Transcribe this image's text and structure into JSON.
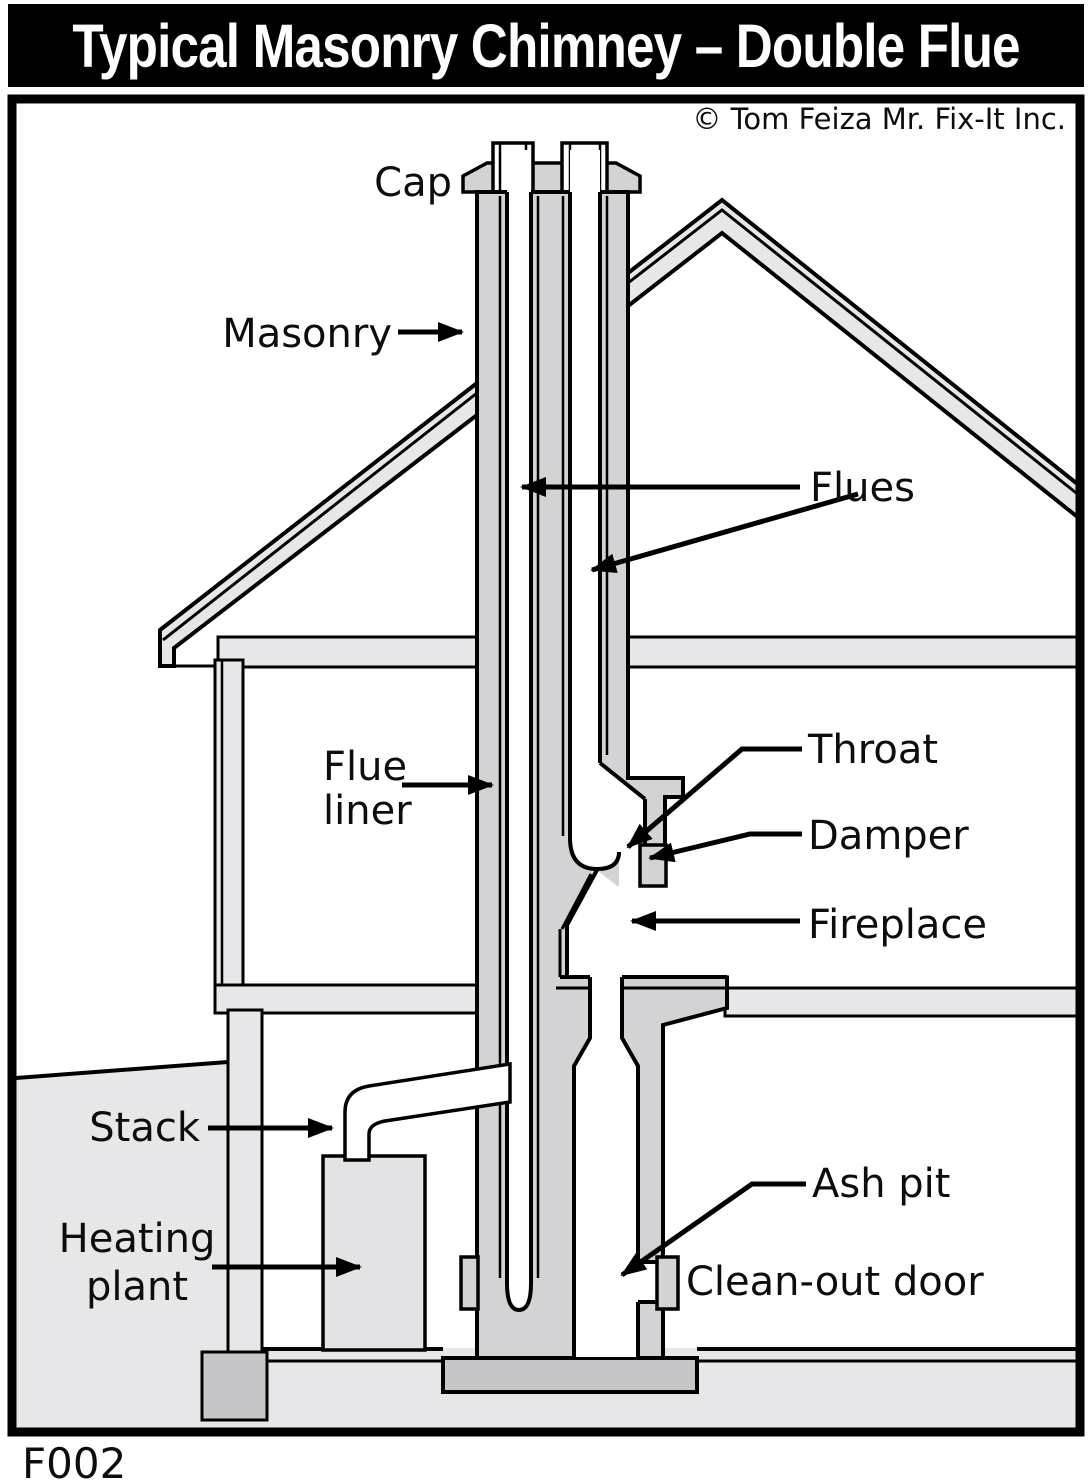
{
  "title": "Typical Masonry Chimney – Double Flue",
  "copyright": "© Tom Feiza Mr. Fix-It Inc.",
  "figure_code": "F002",
  "labels": {
    "cap": "Cap",
    "masonry": "Masonry",
    "flues": "Flues",
    "flue_liner_line1": "Flue",
    "flue_liner_line2": "liner",
    "throat": "Throat",
    "damper": "Damper",
    "fireplace": "Fireplace",
    "stack": "Stack",
    "heating_line1": "Heating",
    "heating_line2": "plant",
    "ash_pit": "Ash pit",
    "cleanout_door": "Clean-out door"
  },
  "colors": {
    "line": "#000000",
    "masonry": "#d3d3d5",
    "roof": "#e7e7e9",
    "footing": "#c6c6c8",
    "equipment": "#e3e3e5",
    "title_bg": "#000000",
    "title_fg": "#ffffff",
    "background": "#ffffff"
  }
}
